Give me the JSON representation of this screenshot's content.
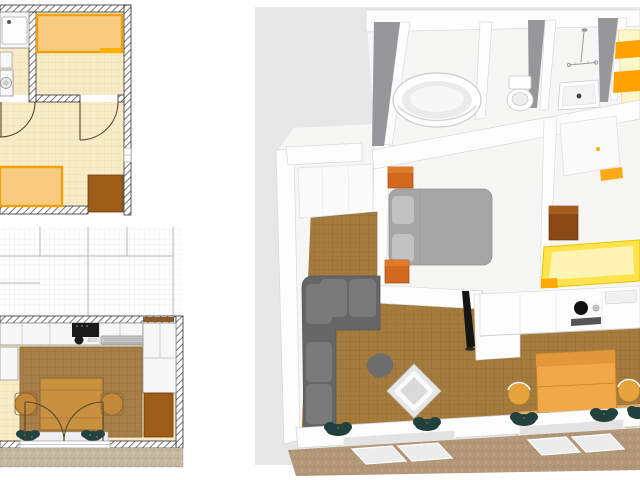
{
  "panels": {
    "plan_upper": {
      "kind": "2d-floor-plan",
      "items": [
        "sink-counter",
        "washing-machine",
        "double-bed",
        "single-bed",
        "wardrobe",
        "door-swing",
        "window"
      ]
    },
    "plan_lower": {
      "kind": "2d-floor-plan",
      "items": [
        "upper-floor-grid",
        "kitchen-counter",
        "stove",
        "sink",
        "radiator",
        "cabinets",
        "rug",
        "dining-table",
        "chairs",
        "french-doors",
        "plants",
        "terrace-gravel"
      ]
    },
    "view_3d": {
      "kind": "3d-render",
      "items": [
        "bathtub",
        "toilet",
        "shower-tray",
        "shower-fixture",
        "bunk-bed",
        "master-bed",
        "nightstands",
        "closet",
        "corner-sofa",
        "pouf",
        "coffee-table",
        "tv",
        "kitchen-counter",
        "stove",
        "oven",
        "sink",
        "dining-table",
        "chairs",
        "yellow-bed",
        "wood-nightstand",
        "door",
        "plants",
        "windows",
        "terrace"
      ]
    }
  },
  "colors": {
    "canvas": "#ffffff",
    "plan": {
      "floor": "#f8ecc8",
      "floor_grid": "#ead9ac",
      "wall_fill": "#ffffff",
      "wall_hatch": "#767676",
      "wall_edge": "#2f2f2f",
      "bed_fill": "#f7cc80",
      "bed_edge": "#efa00b",
      "bed_accent": "#ffb300",
      "cabinet": "#9e5c19",
      "cabinet_edge": "#6b3d0e",
      "counter": "#f7f7f7",
      "counter_edge": "#8f8f8f",
      "appliance_dark": "#1a1a1a",
      "radiator": "#c9c9c9",
      "rug": "#a87f48",
      "rug_line": "#93713f",
      "table": "#c89140",
      "table_edge": "#8d6232",
      "chair": "#c08838",
      "door_arc": "#5a4528",
      "window_line": "#9a9a9a",
      "ghost_grid": "#e0e0e0",
      "ghost_line": "#b5b5b5",
      "plant": "#24423f",
      "plant_light": "#4a6b5e",
      "sill": "#efefef",
      "lintel": "#8a5a28",
      "gravel_base": "#c6b9a1",
      "gravel_dot": "#a89a7e",
      "gravel_dot2": "#d9cfb8"
    },
    "view3d": {
      "bg": "#e7e7e7",
      "floor": "#f6f6f5",
      "wall": "#fdfdfd",
      "wall_edge": "#d9d9d9",
      "wall_face": "#97979a",
      "carpet": "#a57c3e",
      "carpet_line": "#8f6a35",
      "sofa": "#666666",
      "sofa_cushion": "#7a7a7a",
      "pouf": "#6d6d6d",
      "bed_gray": "#a6a6a6",
      "pillow_gray": "#c2c2c2",
      "nightstand": "#d2691e",
      "nightstand_top": "#e07b28",
      "tub_rim": "#c9c9c9",
      "fixture": "#9a9a9a",
      "drain": "#444444",
      "table": "#f0a848",
      "table_edge": "#c8821f",
      "table_band": "#e2973a",
      "chair": "#e8a43c",
      "chair_edge": "#c9962e",
      "bed_yellow": "#ffe34d",
      "bed_yellow_pale": "#fdf3b3",
      "bed_yellow_edge": "#e6c200",
      "pillow_orange": "#ffa200",
      "bunk_pale": "#fdf6c8",
      "wood_cabinet": "#8b4a15",
      "wood_cabinet_top": "#a55d1f",
      "tv": "#151515",
      "oven": "#555555",
      "glass": "#e3e3e3",
      "leaf": "#ececec",
      "rug_dining": "#e8b264",
      "handle": "#e2b200",
      "plant": "#22413e",
      "plant_light": "#4a6b5e",
      "terrace": "#b29878",
      "terrace_dot": "#9c8260",
      "terrace_dot2": "#c6b091"
    }
  }
}
